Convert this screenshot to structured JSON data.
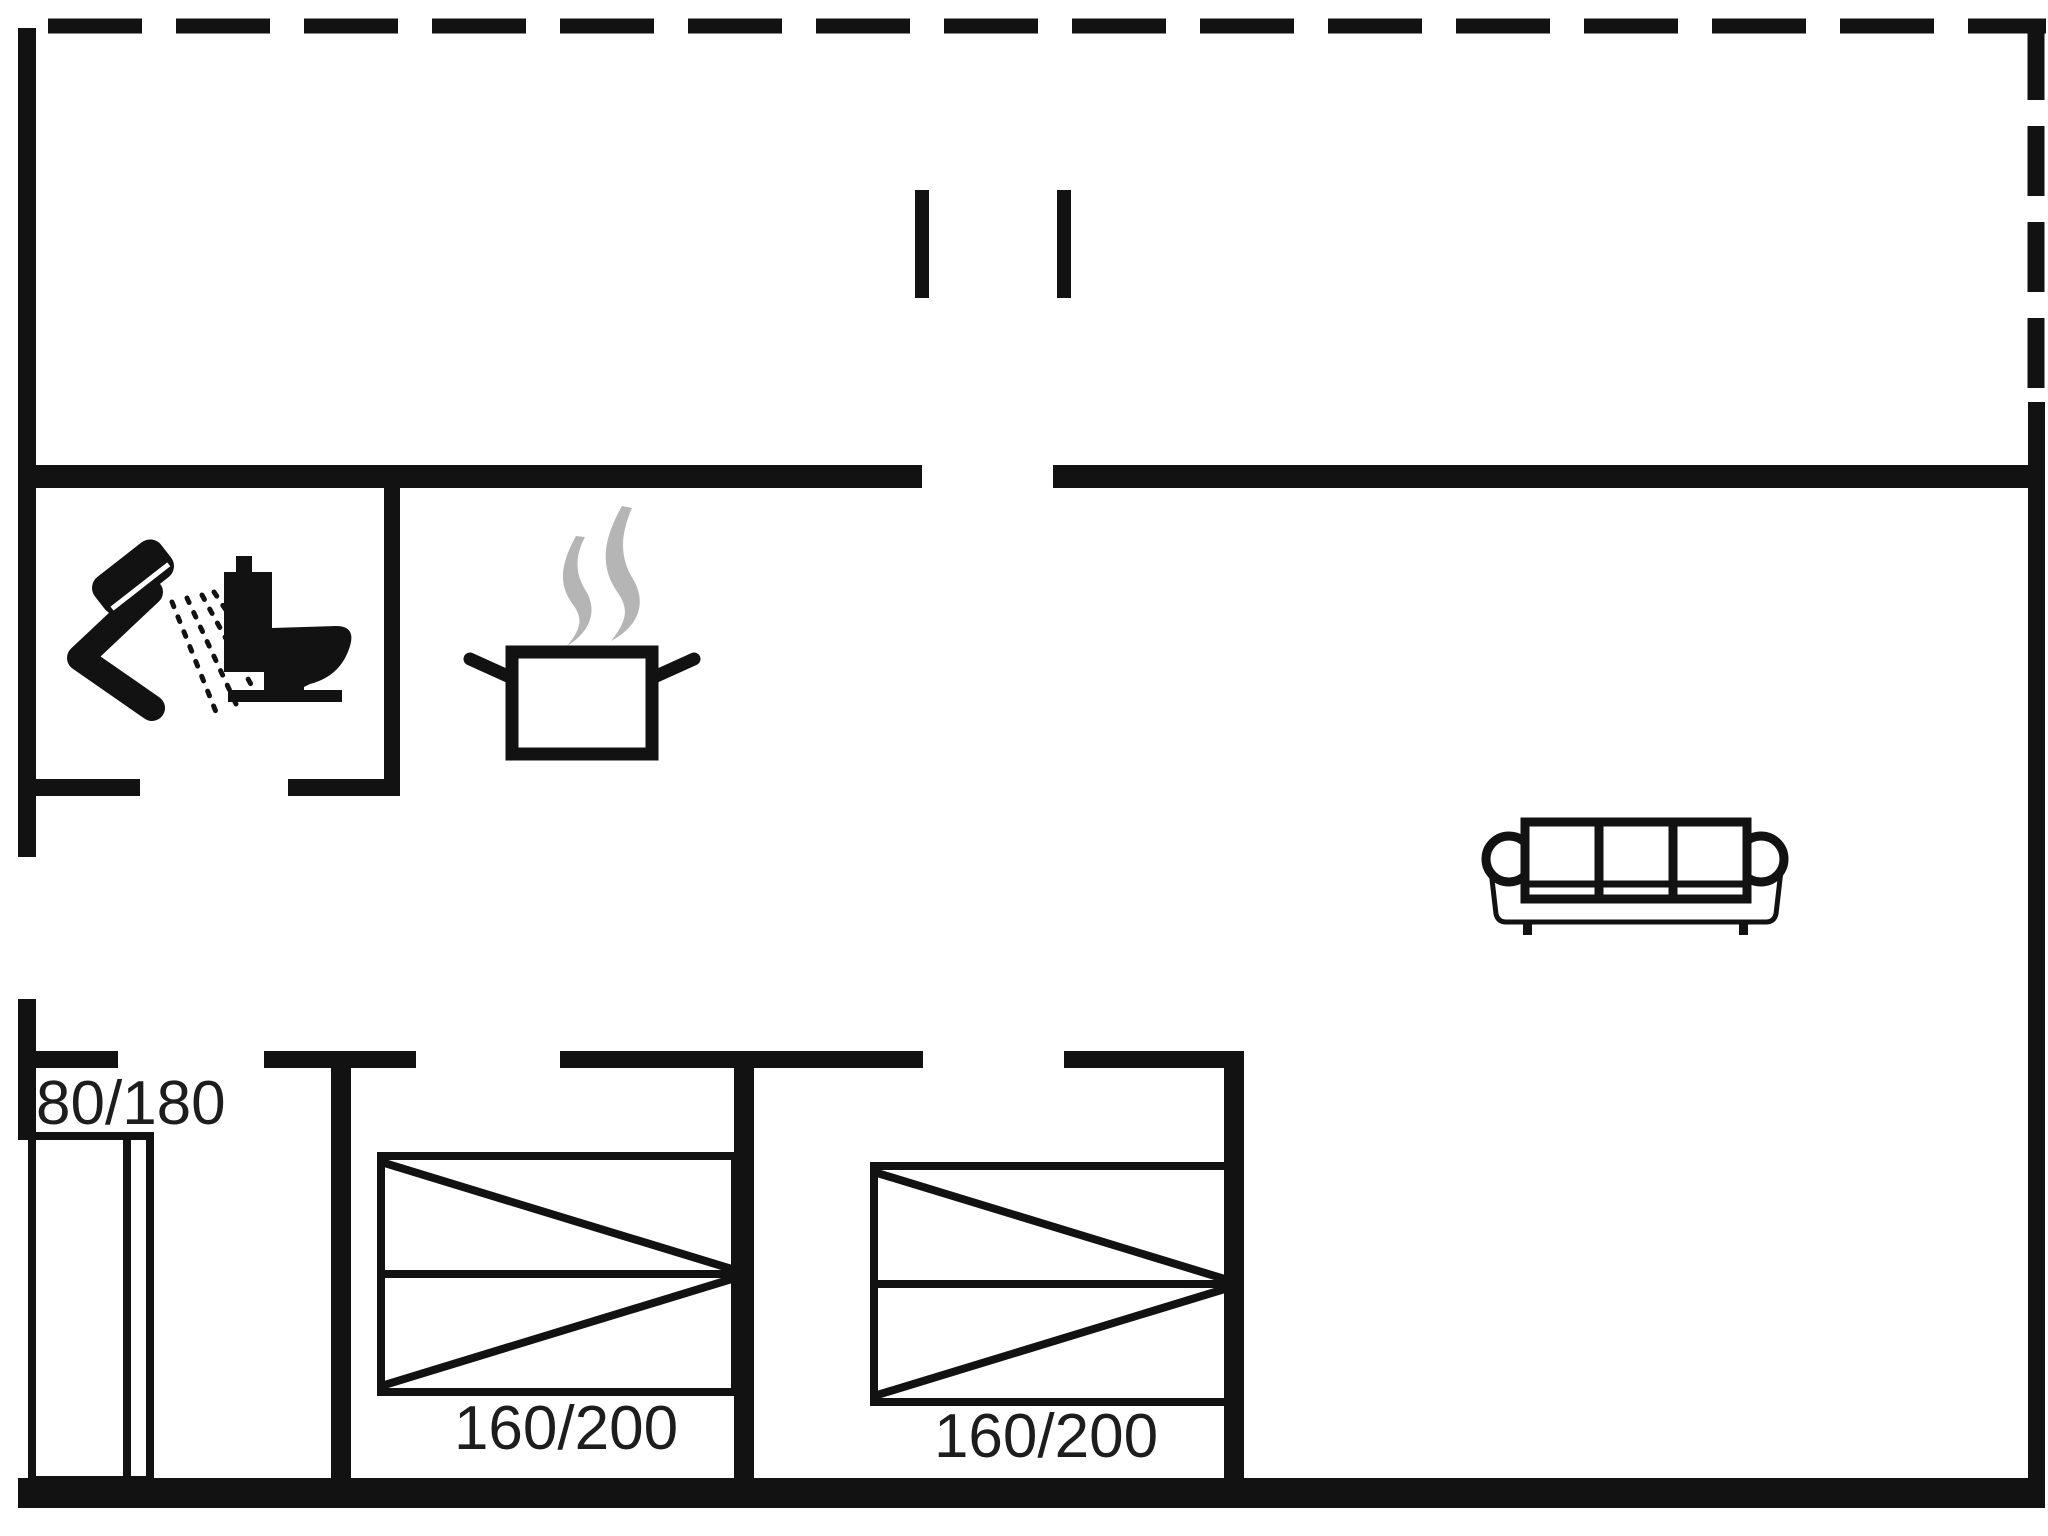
{
  "colors": {
    "bg": "#ffffff",
    "wall": "#121212",
    "steam": "#b5b5b5",
    "text": "#1d1d1d"
  },
  "labels": {
    "hall_bed": "80/180",
    "bedroom1_bed": "160/200",
    "bedroom2_bed": "160/200"
  },
  "icons": {
    "bathroom": [
      "shower-icon",
      "toilet-icon"
    ],
    "kitchen": [
      "cooking-pot-icon",
      "steam-icon"
    ],
    "living_room": [
      "sofa-icon"
    ],
    "beds": [
      "single-bed-symbol",
      "double-bed-symbol",
      "double-bed-symbol"
    ]
  }
}
